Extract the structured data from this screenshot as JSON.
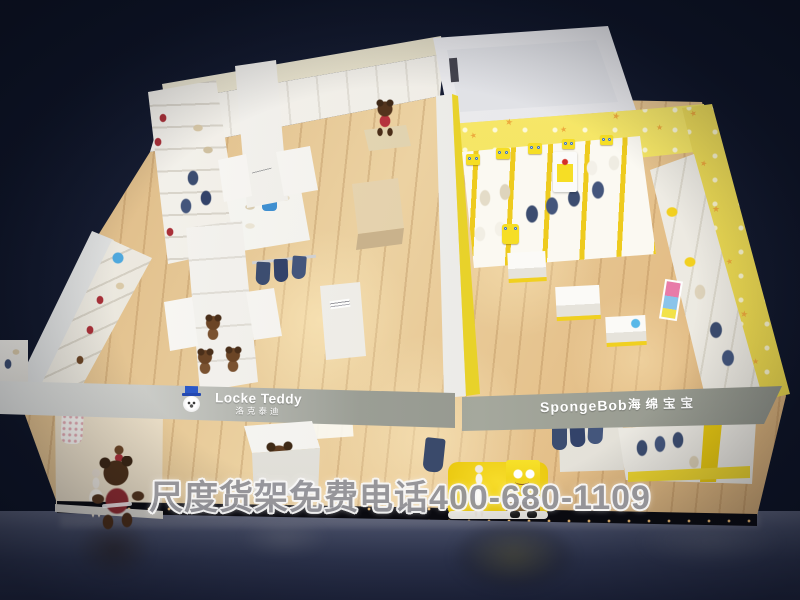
{
  "scene": {
    "type": "3d-store-render",
    "description": "Bird's-eye 3D render of a children's clothing shop floating on a dark navy backdrop, split into a Locke Teddy zone (white shelving, teddy-bear mascots) and a SpongeBob zone (yellow star-patterned walls, SpongeBob plush figures)"
  },
  "signs": {
    "locke_teddy": {
      "brand": "Locke Teddy",
      "brand_cn": "洛克泰迪",
      "logo": "teddy-bear-top-hat-icon"
    },
    "spongebob": {
      "brand": "SpongeBob",
      "brand_cn": "海绵宝宝"
    }
  },
  "watermark": {
    "text": "尺度货架免费电话400-680-1109"
  },
  "colors": {
    "background_navy": "#0e1426",
    "wood_floor": "#e6c291",
    "fascia_gray": "#8e9188",
    "shelf_white": "#f4f2ee",
    "brand_yellow": "#f2d527",
    "cream_beam": "#ece7d2",
    "bear_brown": "#4c3019",
    "sweater_red": "#8e2b30",
    "garment_navy": "#3c4d70",
    "mirror_floor": "#3a415c"
  }
}
